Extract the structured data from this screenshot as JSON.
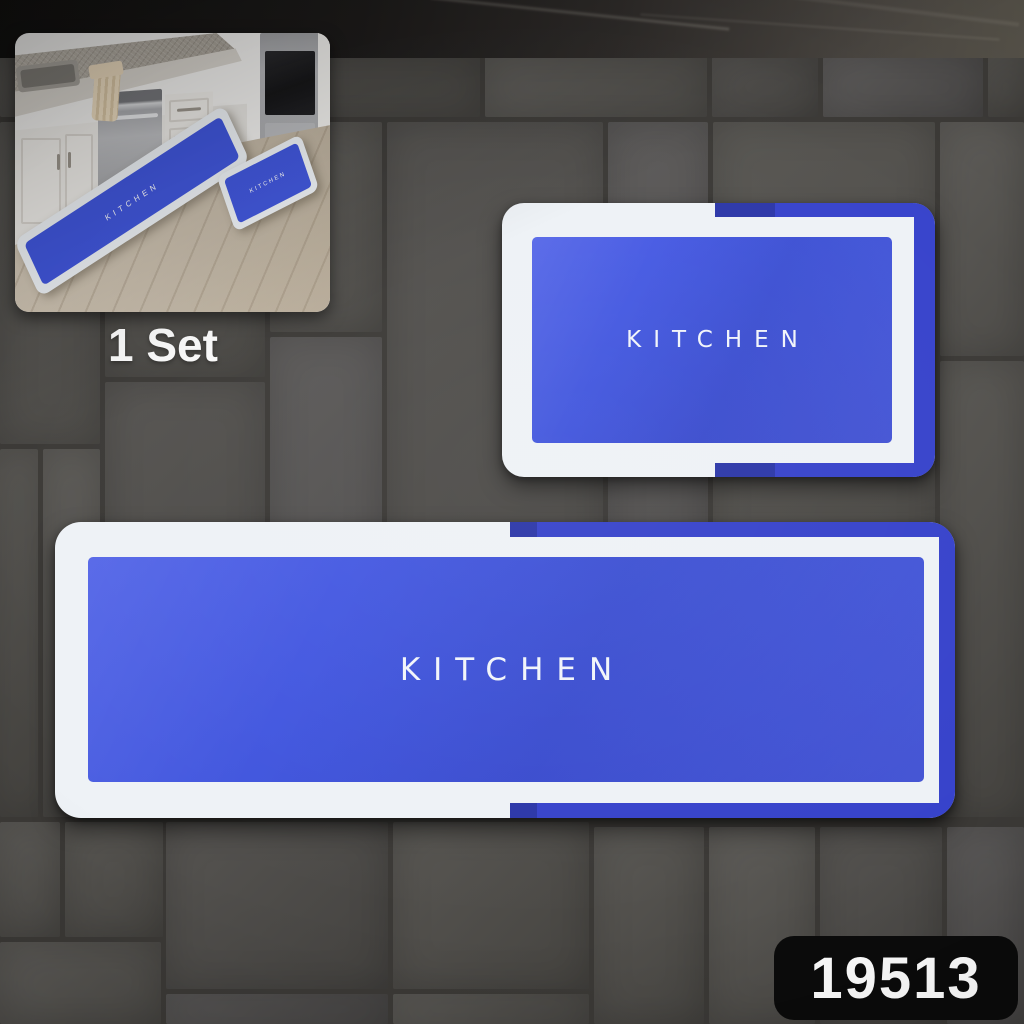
{
  "scene": {
    "set_label": "1 Set",
    "sku_label": "19513"
  },
  "mats": {
    "large_runner": {
      "text": "KITCHEN"
    },
    "small_mat": {
      "text": "KITCHEN"
    }
  },
  "inset": {
    "runner_mat_text": "KITCHEN",
    "small_mat_text": "KITCHEN"
  },
  "colors": {
    "mat_center_blue": "#4156de",
    "mat_border_blue": "#3743cb",
    "mat_accent_navy": "#2c37a8",
    "mat_white": "#eef2f6",
    "tile_gray": "#51504c",
    "grout_gray": "#3b3936",
    "counter_black": "#1d1b1a",
    "floor_wood": "#c7bcab",
    "label_bg": "#0b0b0b",
    "label_text": "#ffffff",
    "set_text_color": "#fdfdfd"
  }
}
